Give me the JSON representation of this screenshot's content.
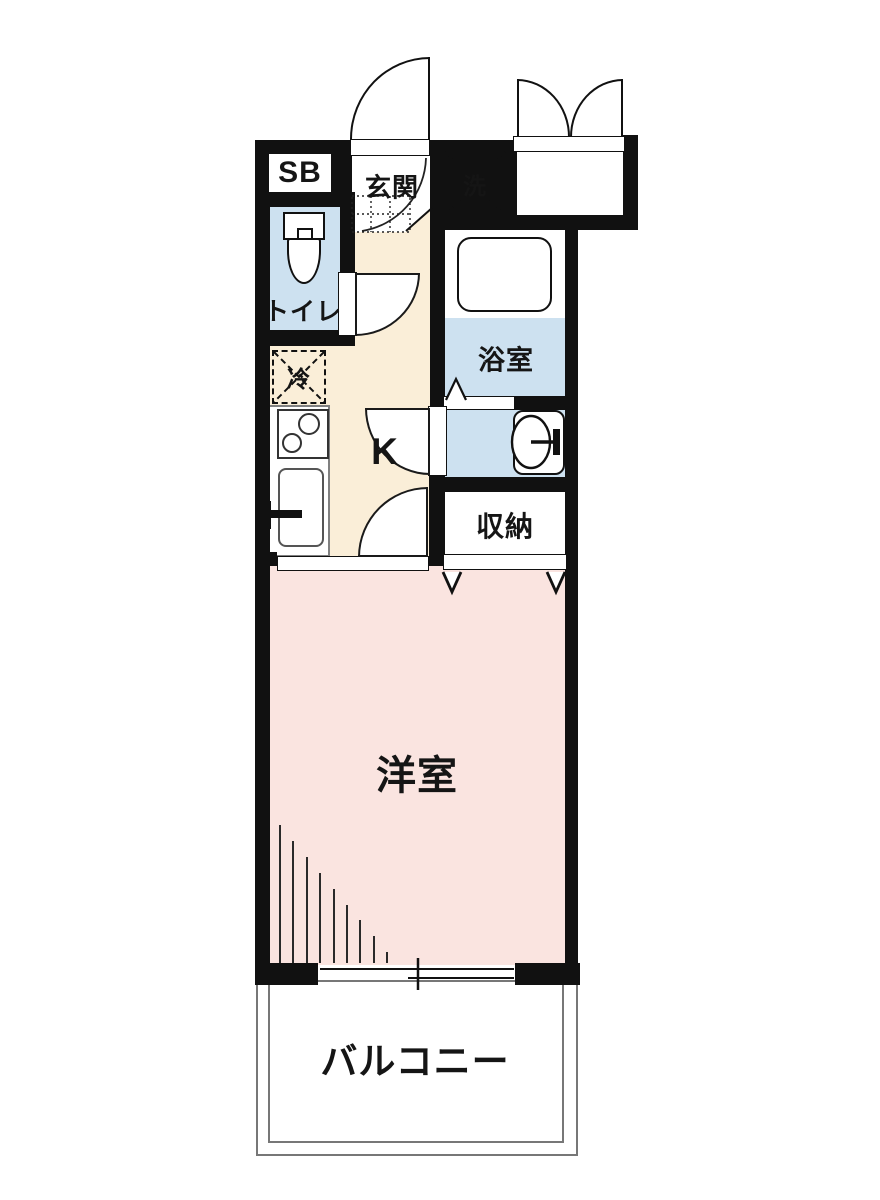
{
  "floorplan": {
    "rooms": {
      "shoe_box": {
        "label": "SB"
      },
      "entrance": {
        "label": "玄関"
      },
      "washer": {
        "label": "洗"
      },
      "toilet": {
        "label": "トイレ"
      },
      "bathroom": {
        "label": "浴室"
      },
      "refrigerator": {
        "label": "冷"
      },
      "kitchen": {
        "label": "K"
      },
      "storage": {
        "label": "収納"
      },
      "western_room": {
        "label": "洋室"
      },
      "balcony": {
        "label": "バルコニー"
      }
    },
    "colors": {
      "wall": "#111111",
      "wet_area_blue": "#cde1f0",
      "kitchen_cream": "#faeed8",
      "room_pink": "#fae4e0",
      "counter_gray": "#808080",
      "balcony_border": "#777777"
    }
  }
}
